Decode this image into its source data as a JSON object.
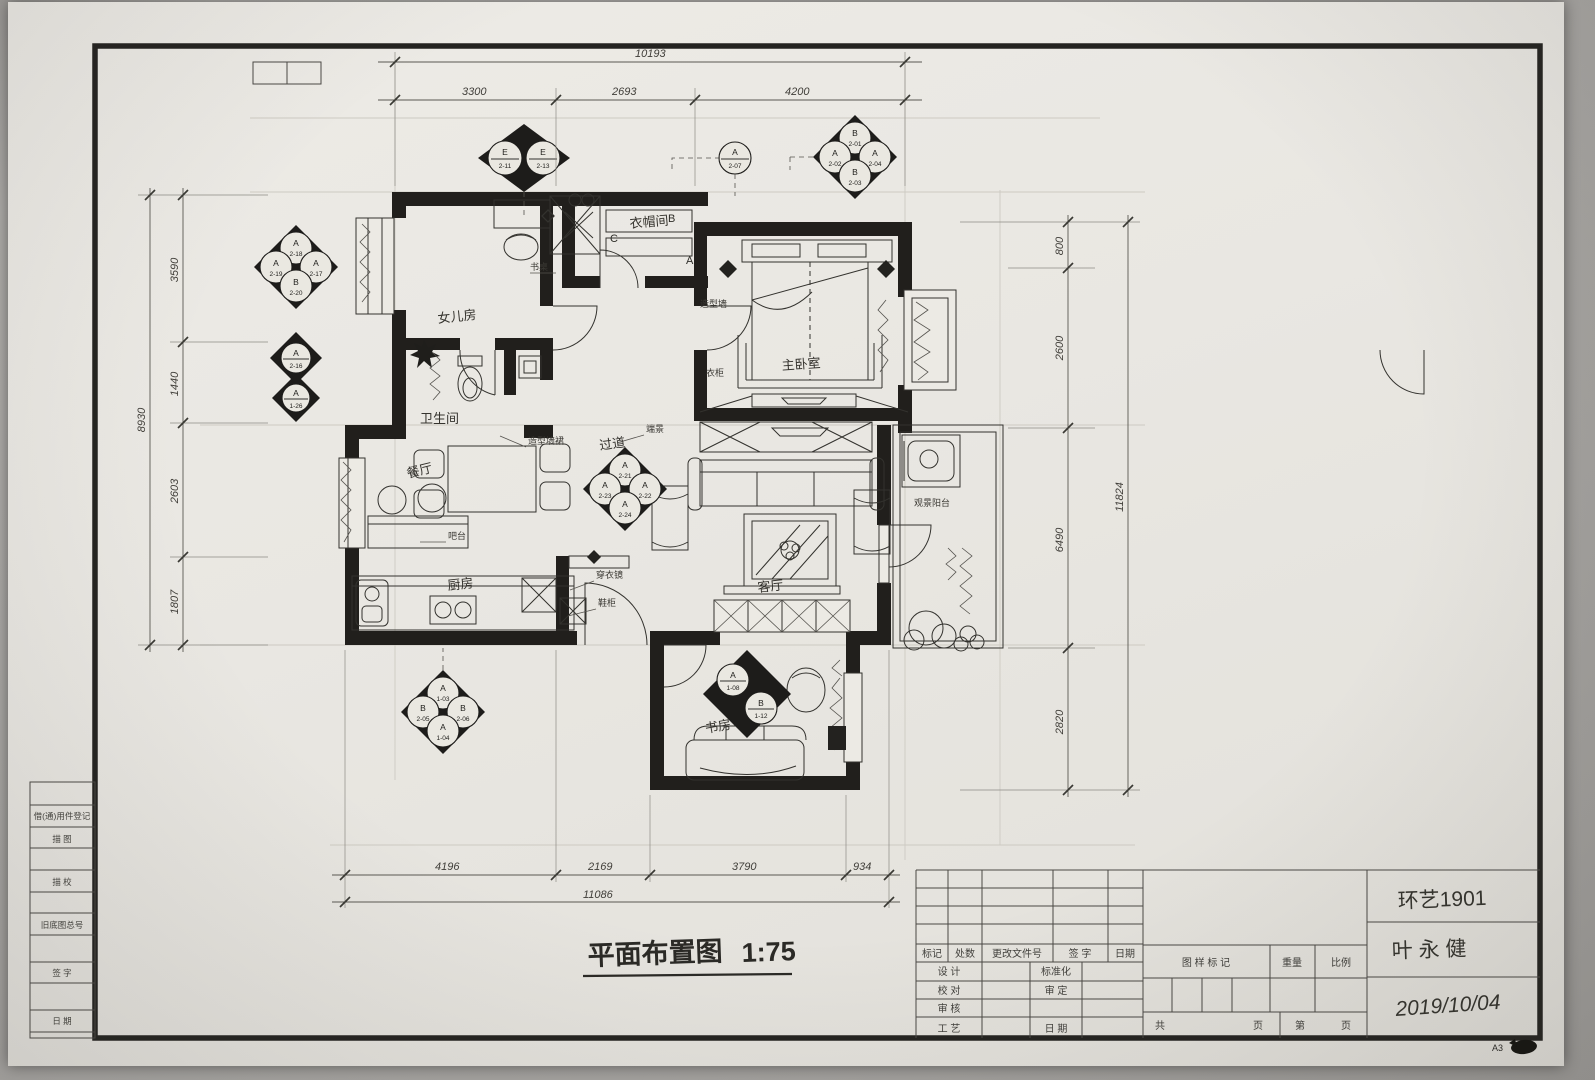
{
  "photo": {
    "sheet_code": "A3"
  },
  "drawing_title": {
    "text": "平面布置图",
    "scale": "1:75"
  },
  "rooms": {
    "daughter": "女儿房",
    "bath": "卫生间",
    "corridor": "过道",
    "cloak": "衣帽间",
    "master": "主卧室",
    "dining": "餐厅",
    "bar": "吧台",
    "kitchen": "厨房",
    "living": "客厅",
    "study": "书房",
    "balcony": "观景阳台"
  },
  "annotations": {
    "dado": "造型墙裙",
    "feature_wall": "造型墙",
    "wardrobe": "衣柜",
    "desk": "书桌",
    "end_view": "端景",
    "mirror": "穿衣镜",
    "shoe_cabinet": "鞋柜"
  },
  "section_letters": {
    "a": "A",
    "b": "B",
    "c": "C"
  },
  "dimensions": {
    "top": {
      "total": "10193",
      "segments": [
        "3300",
        "2693",
        "4200"
      ]
    },
    "bottom": {
      "total": "11086",
      "segments": [
        "4196",
        "2169",
        "3790",
        "934"
      ]
    },
    "left": {
      "total": "8930",
      "segments": [
        "3590",
        "1440",
        "2603",
        "1807"
      ]
    },
    "right": {
      "total": "11824",
      "segments": [
        "800",
        "2600",
        "6490",
        "2820"
      ]
    }
  },
  "markers": [
    {
      "a": "E",
      "an": "2-11",
      "b": "E",
      "bn": "2-13"
    },
    {
      "a": "A",
      "an": "2-07"
    },
    {
      "t": "B",
      "tn": "2-01",
      "l": "A",
      "ln": "2-02",
      "r": "A",
      "rn": "2-04",
      "b": "B",
      "bn": "2-03"
    },
    {
      "t": "A",
      "tn": "2-18",
      "l": "A",
      "ln": "2-19",
      "r": "A",
      "rn": "2-17",
      "b": "B",
      "bn": "2-20"
    },
    {
      "a": "A",
      "an": "2-16"
    },
    {
      "a": "A",
      "an": "1-26"
    },
    {
      "t": "A",
      "tn": "2-21",
      "l": "A",
      "ln": "2-23",
      "r": "A",
      "rn": "2-22",
      "b": "A",
      "bn": "2-24"
    },
    {
      "t": "A",
      "tn": "1-03",
      "l": "B",
      "ln": "2-05",
      "r": "B",
      "rn": "2-06",
      "b": "A",
      "bn": "1-04"
    },
    {
      "a": "A",
      "an": "1-08",
      "b": "B",
      "bn": "1-12"
    }
  ],
  "left_strip": {
    "rows": [
      "借(通)用件登记",
      "描  图",
      "描  校",
      "旧底图总号",
      "签  字",
      "日  期"
    ]
  },
  "title_block": {
    "rev_header": [
      "标记",
      "处数",
      "更改文件号",
      "签 字",
      "日期"
    ],
    "design": "设 计",
    "standard": "标准化",
    "check": "校 对",
    "approve": "审 定",
    "audit": "审 核",
    "craft": "工 艺",
    "date_label": "日 期",
    "mark_label": "图 样 标 记",
    "weight_label": "重量",
    "scale_label": "比例",
    "total_label": "共",
    "page_label": "页",
    "no_label": "第",
    "page_label2": "页",
    "class_name": "环艺1901",
    "student_name": "叶 永 健",
    "date_value": "2019/10/04"
  }
}
